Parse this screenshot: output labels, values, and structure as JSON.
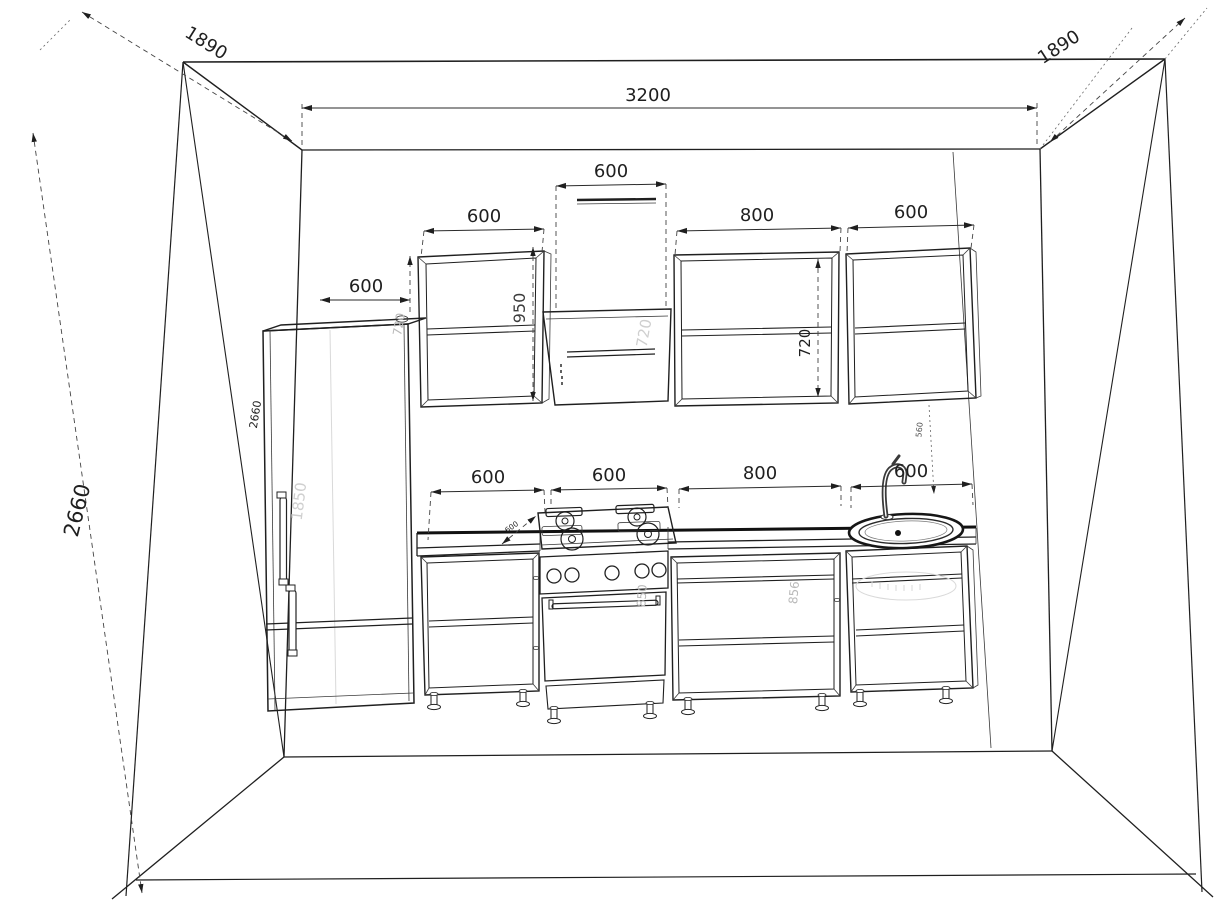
{
  "drawing": {
    "type": "kitchen-elevation-perspective",
    "colors": {
      "line": "#1f1f1f",
      "dimension": "#2a2a2a",
      "faint_label": "#b9b9b9",
      "background": "#ffffff"
    },
    "dims": {
      "room_width": "3200",
      "room_height": "2660",
      "corner_height": "2660",
      "ceiling_depth_left": "1890",
      "ceiling_depth_right": "1890",
      "fridge_width": "600",
      "fridge_height": "1850",
      "wall_cabinet_left_width": "600",
      "hood_width": "600",
      "wall_cabinet_mid_width": "800",
      "wall_cabinet_right_width": "600",
      "wall_cabinet_left_height": "950",
      "wall_cabinet_height": "720",
      "hood_height": "720",
      "wall_cabinet_left_height_partial": "720",
      "base_cabinet1_width": "600",
      "stove_width": "600",
      "base_cabinet2_width": "800",
      "sink_cabinet_width": "600",
      "stove_height": "850",
      "base_cabinet_height": "856",
      "counter_depth": "600",
      "wall_gap_height": "560"
    }
  }
}
